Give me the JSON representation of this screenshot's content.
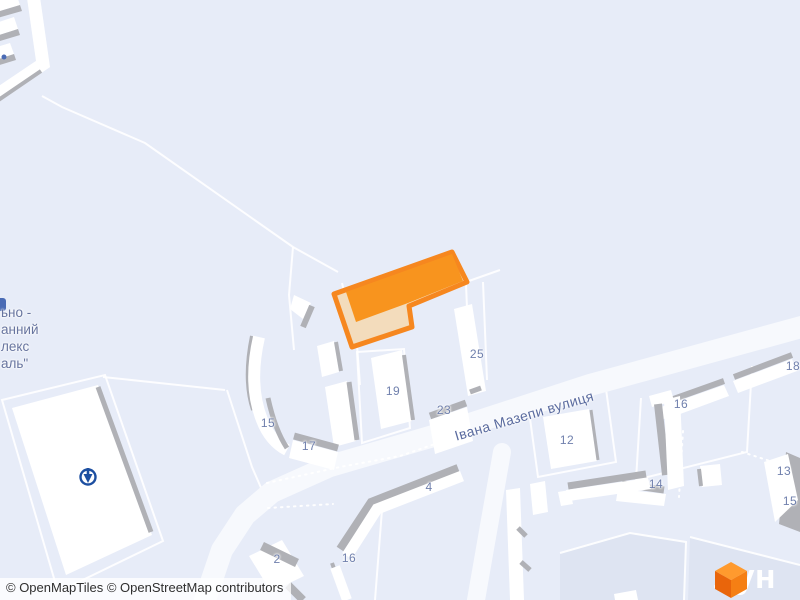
{
  "colors": {
    "background": "#e7ecf8",
    "building_fill": "#ffffff",
    "building_shadow": "#b0b1b6",
    "parcel_line": "#ffffff",
    "road_fill": "#f7f9fd",
    "zone_dark": "#dee4f2",
    "label_text": "#7080ad",
    "street_text": "#5a6b9f",
    "selected_border": "#f6871f",
    "selected_roof": "#f8941e",
    "selected_side": "#f3dcbc",
    "poi_blue": "#1d4fa1",
    "logo_orange": "#f47119"
  },
  "map": {
    "street_label": "Івана Мазепи вулиця",
    "poi_label_lines": [
      "ьно -",
      "анний",
      "лекс",
      "аль\""
    ],
    "poi_icon": "circle-down-arrow-icon",
    "selected_building": "orange highlighted L-shaped building",
    "building_labels": [
      {
        "text": "15",
        "x": 268,
        "y": 423
      },
      {
        "text": "17",
        "x": 309,
        "y": 446
      },
      {
        "text": "19",
        "x": 393,
        "y": 391
      },
      {
        "text": "23",
        "x": 444,
        "y": 410
      },
      {
        "text": "25",
        "x": 477,
        "y": 354
      },
      {
        "text": "12",
        "x": 567,
        "y": 440
      },
      {
        "text": "4",
        "x": 429,
        "y": 487
      },
      {
        "text": "2",
        "x": 277,
        "y": 559
      },
      {
        "text": "16",
        "x": 349,
        "y": 558
      },
      {
        "text": "16",
        "x": 681,
        "y": 404
      },
      {
        "text": "14",
        "x": 656,
        "y": 484
      },
      {
        "text": "18",
        "x": 793,
        "y": 366
      },
      {
        "text": "13",
        "x": 784,
        "y": 471
      },
      {
        "text": "15",
        "x": 790,
        "y": 501
      }
    ]
  },
  "attribution": {
    "text": "© OpenMapTiles © OpenStreetMap contributors"
  },
  "logo": {
    "text": "лун"
  }
}
